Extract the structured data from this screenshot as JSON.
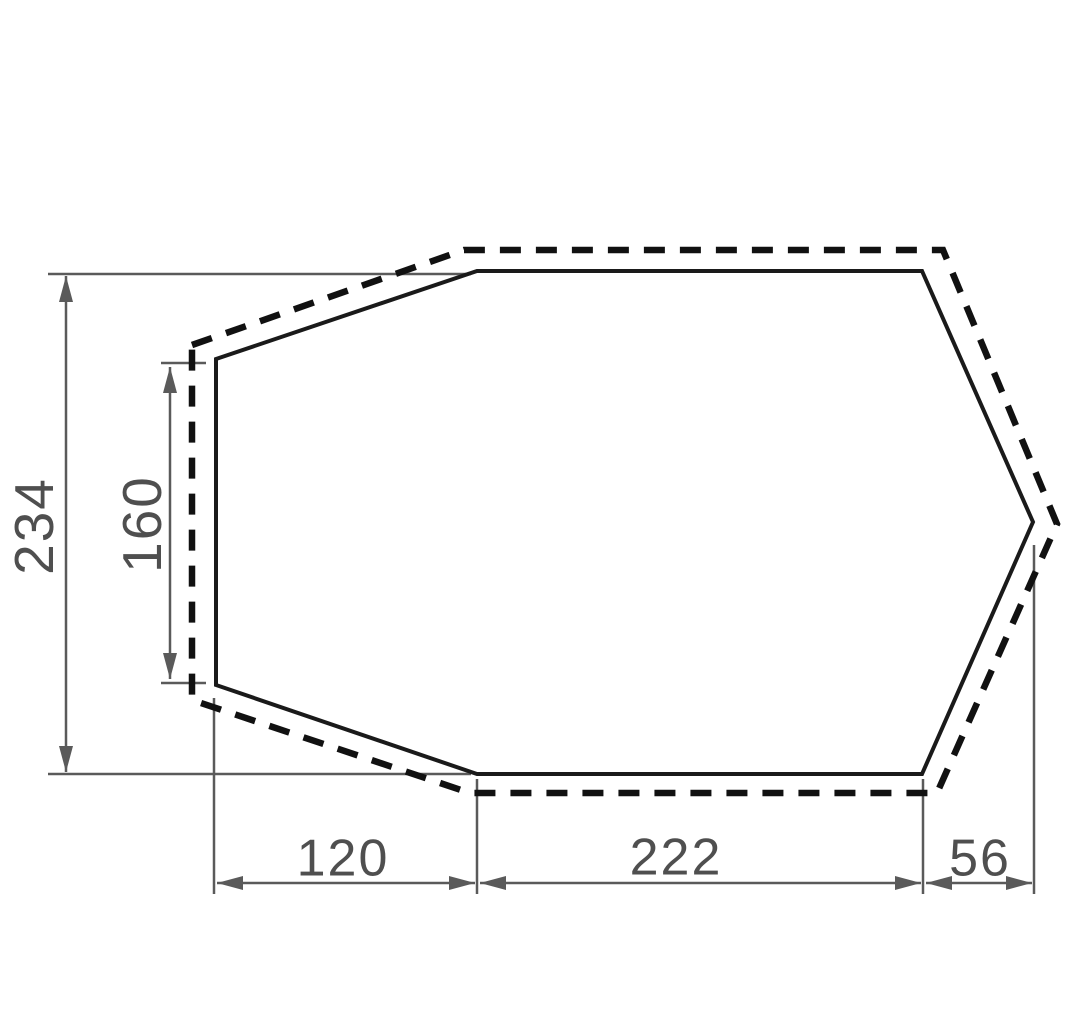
{
  "figure": {
    "description": "Technical dimension drawing of a hexagonal tent footprint: solid inner outline with dashed outer outline and five dimension callouts",
    "canvas": {
      "width": 1080,
      "height": 1034,
      "background": "#ffffff"
    },
    "style": {
      "outline_color": "#1a1a1a",
      "dashed_color": "#111111",
      "dimension_color": "#5a5a5a",
      "label_color": "#4f4f4f",
      "outline_width": 4,
      "dashed_width": 6.5,
      "dash_pattern": "21 15",
      "dimension_width": 2.5,
      "arrow_length": 26,
      "arrow_half_width": 7,
      "label_font_size_horizontal": 52,
      "label_font_size_vertical": 55
    },
    "solid_polygon": [
      [
        216,
        359
      ],
      [
        477,
        271
      ],
      [
        922,
        271
      ],
      [
        1033,
        522
      ],
      [
        922,
        774
      ],
      [
        477,
        774
      ],
      [
        216,
        685
      ]
    ],
    "dashed_polygon": [
      [
        192,
        345
      ],
      [
        464,
        250
      ],
      [
        943,
        250
      ],
      [
        1057,
        524
      ],
      [
        937,
        793
      ],
      [
        470,
        793
      ],
      [
        192,
        700
      ]
    ],
    "dimensions": [
      {
        "id": "height-234",
        "label": "234",
        "orientation": "vertical",
        "x": 66,
        "from": 276,
        "to": 772,
        "extensions": [
          [
            48,
            274,
            471,
            274
          ],
          [
            48,
            774,
            471,
            774
          ]
        ],
        "label_pos": [
          33,
          526
        ]
      },
      {
        "id": "left-edge-160",
        "label": "160",
        "orientation": "vertical",
        "x": 170,
        "from": 367,
        "to": 679,
        "extensions": [
          [
            161,
            363,
            206,
            363
          ],
          [
            161,
            683,
            206,
            683
          ]
        ],
        "label_pos": [
          141,
          524
        ]
      },
      {
        "id": "bottom-left-120",
        "label": "120",
        "orientation": "horizontal",
        "y": 883,
        "from": 217,
        "to": 475,
        "extensions": [
          [
            214,
            698,
            214,
            894
          ],
          [
            477,
            779,
            477,
            894
          ]
        ],
        "label_pos": [
          343,
          857
        ]
      },
      {
        "id": "bottom-middle-222",
        "label": "222",
        "orientation": "horizontal",
        "y": 883,
        "from": 480,
        "to": 921,
        "extensions": [
          [
            923,
            779,
            923,
            894
          ]
        ],
        "label_pos": [
          676,
          856
        ]
      },
      {
        "id": "bottom-right-56",
        "label": "56",
        "orientation": "horizontal",
        "y": 883,
        "from": 926,
        "to": 1032,
        "extensions": [
          [
            1034,
            545,
            1034,
            894
          ]
        ],
        "label_pos": [
          980,
          857
        ]
      }
    ]
  }
}
